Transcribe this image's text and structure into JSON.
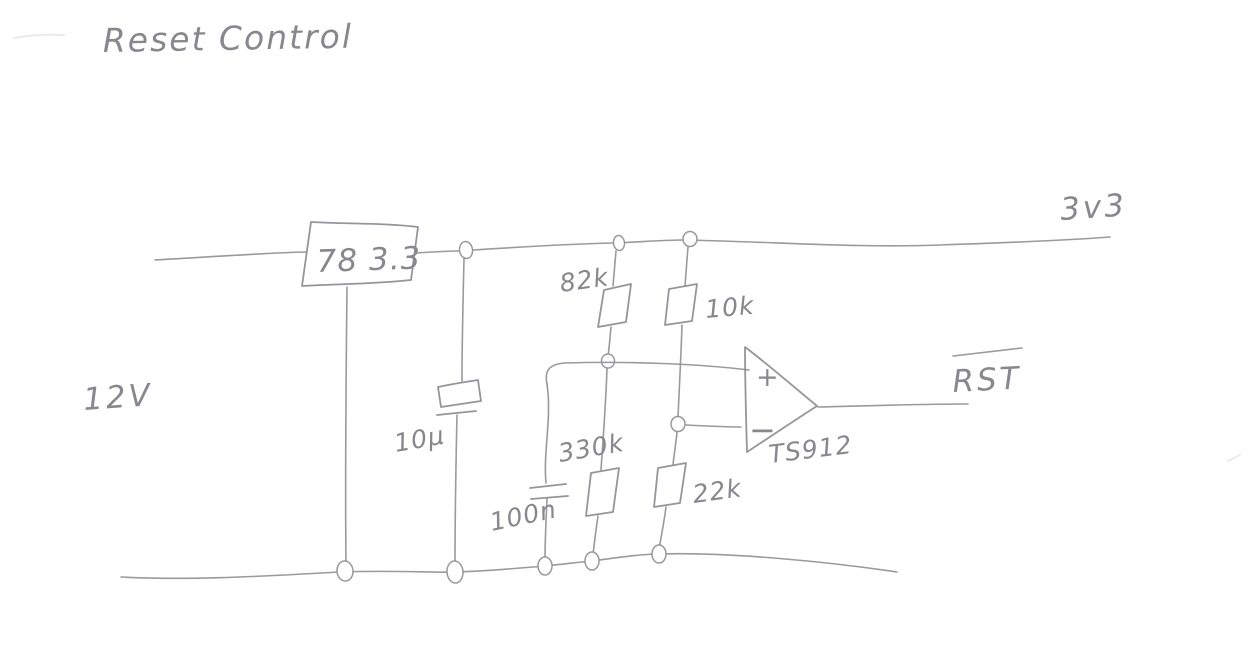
{
  "schematic": {
    "heading": "Reset Control",
    "rails": {
      "input": "12V",
      "output": "3v3"
    },
    "components": {
      "regulator": "78 3.3",
      "bulk_cap": "10μ",
      "filter_cap": "100n",
      "r_upper_left": "82k",
      "r_upper_right": "10k",
      "r_lower_left": "330k",
      "r_lower_right": "22k",
      "comparator": "TS912"
    },
    "opamp": {
      "plus": "+",
      "minus": "−"
    },
    "output_signal": "RST",
    "output_signal_active_low": true,
    "style": {
      "pencil": "#8f8f94",
      "paper": "#ffffff"
    }
  }
}
